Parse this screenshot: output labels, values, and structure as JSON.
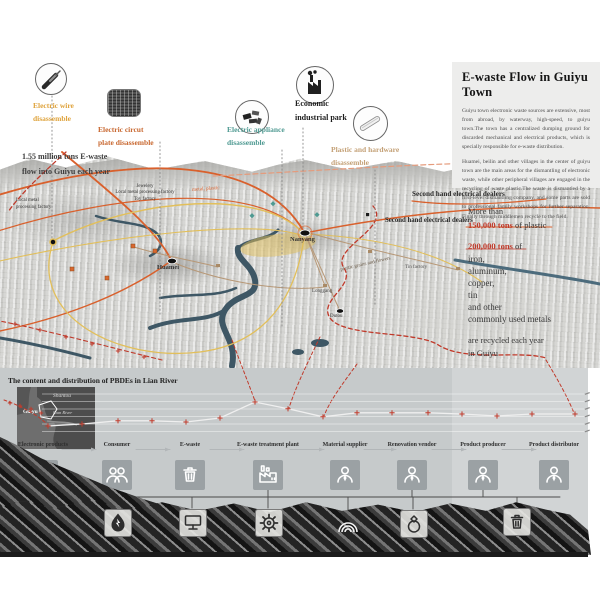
{
  "poster": {
    "inflow_note": "1.55 million tons E-waste\nflow into Guiyu each year",
    "annotations": [
      {
        "id": "wire",
        "label": "Electric wire\ndisassemble",
        "color": "#DFA33C",
        "icon": "wire-icon"
      },
      {
        "id": "circuit",
        "label": "Electric circut\nplate disassemble",
        "color": "#C8672F",
        "icon": "circuit-board-icon"
      },
      {
        "id": "appliance",
        "label": "Electric appliance\ndisassemble",
        "color": "#4F9A92",
        "icon": "appliance-icon"
      },
      {
        "id": "industrial",
        "label": "Economic\nindustrial park",
        "color": "#1d1d1d",
        "icon": "factory-icon"
      },
      {
        "id": "plastic",
        "label": "Plastic and hardware\ndisassemble",
        "color": "#C4A177",
        "icon": "tool-icon"
      }
    ],
    "panel": {
      "title": "E-waste Flow in Guiyu Town",
      "para1": "Guiyu town electronic waste sources are extensive, most from abroad, by waterway, high-speed, to guiyu town.The town has a centralized dumping ground for discarded mechanical and electrical products, which is specially responsible for e-waste distribution.",
      "para2": "Huamei, beilin and other villages in the center of guiyu town are the main areas for the dismantling of electronic waste, while other peripheral villages are engaged in the recycling of waste plastic.The waste is dismantled by a first-level dismantling company, and some parts are sold to professional family workshops for further separation. Finally through middlemen recycle to the field."
    },
    "stats": {
      "lead": "More than",
      "plastic_amount": "150,000 tons",
      "plastic_unit": " of plastic",
      "metal_amount": "200,000 tons",
      "metal_unit": " of",
      "metals": [
        "iron,",
        "aluminum,",
        "copper,",
        "tin",
        "and other",
        "commonly used metals"
      ],
      "closing": "are recycled each year\nin Guiyu",
      "accent_color": "#C03A2B"
    },
    "map_labels": {
      "factory_left": "Local metal\nprocessing factory",
      "factory_cluster": "Jewelery\nLocal metal processing factory\nToy factory",
      "metal_plastic": "metal, plastic",
      "dealers1": "Second hand electrical dealers",
      "dealers2": "Second hand electrical dealers",
      "plastic_grains": "plastic grains and flowers",
      "tin_factory": "Tin factory",
      "places": {
        "huamei": "Huamei",
        "nanyang": "Nanyang",
        "longgang": "Longgang",
        "dutou": "Dutou"
      }
    },
    "flow": {
      "stations": [
        {
          "label": "Electronic products",
          "icon": "monitor"
        },
        {
          "label": "Consumer",
          "icon": "people"
        },
        {
          "label": "E-waste",
          "icon": "trash"
        },
        {
          "label": "E-waste treatment plant",
          "icon": "plant"
        },
        {
          "label": "Material supplier",
          "icon": "person"
        },
        {
          "label": "Renovation vendor",
          "icon": "person"
        },
        {
          "label": "Product producer",
          "icon": "person"
        },
        {
          "label": "Product distributor",
          "icon": "person"
        }
      ]
    },
    "bottom_icons": [
      {
        "name": "energy-drop-icon",
        "glyph": "energy"
      },
      {
        "name": "computer-icon",
        "glyph": "monitor-dark"
      },
      {
        "name": "gear-icon",
        "glyph": "gear"
      },
      {
        "name": "arcs-icon",
        "glyph": "arcs"
      },
      {
        "name": "ring-icon",
        "glyph": "ring"
      },
      {
        "name": "trash-icon",
        "glyph": "trash-dark"
      }
    ]
  },
  "chart_data": {
    "type": "line",
    "title": "The content and distribution of PBDEs in Lian River",
    "x": [
      "S1",
      "S2",
      "S3",
      "S4",
      "S5",
      "S6",
      "S7",
      "S8",
      "S9",
      "S10",
      "S11",
      "S12",
      "S13",
      "S14",
      "S15",
      "S16"
    ],
    "values": [
      1.5,
      2.0,
      2.8,
      2.8,
      2.5,
      3.5,
      7.5,
      5.8,
      3.8,
      4.8,
      4.8,
      4.8,
      4.5,
      4.0,
      4.5,
      4.5
    ],
    "ylabel": "PBDE level (relative, axis unlabeled in source)",
    "xlabel": "sampling sites along Lian River",
    "line_color": "#efefef",
    "marker": "red-plus",
    "marker_color": "#C03A2B",
    "grid": true,
    "legend": "none",
    "inset_map_labels": [
      "Shantou",
      "Guiyu",
      "Lian River"
    ],
    "note": "values estimated from unlabeled gridlines; peak at site S7"
  }
}
